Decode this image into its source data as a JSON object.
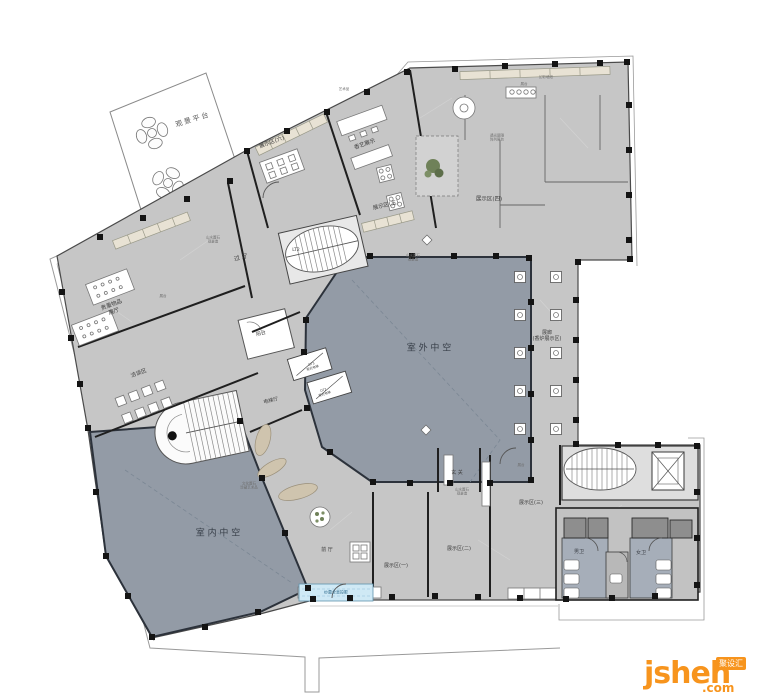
{
  "document": {
    "type": "architectural-floor-plan"
  },
  "colors": {
    "floor": "#c6c6c6",
    "atrium_blue": "#939ba6",
    "restroom_blue": "#a6aeb9",
    "stall_gray": "#8e8e8e",
    "wall_black": "#1f1f1f",
    "outline": "#4a4a4a",
    "site_line": "#9a9a9a",
    "counter_tan": "#e8e2d4",
    "glass_blue": "#cfe9f5",
    "plant_green": "#6f8159",
    "sculpture_tan": "#cfc4ae",
    "logo_orange": "#f7941d"
  },
  "watermark": {
    "brand": "jsheh",
    "tld": ".com",
    "badge": "聚设汇"
  },
  "plan": {
    "rooms": [
      {
        "id": "viewing-platform",
        "label": "观景平台"
      },
      {
        "id": "display-area-6",
        "label": "展示区(六)"
      },
      {
        "id": "incense-art-display",
        "label": "香艺展示"
      },
      {
        "id": "display-area-5",
        "label": "展示区(五)"
      },
      {
        "id": "display-area-4",
        "label": "展示区(四)"
      },
      {
        "id": "gallery-corridor",
        "label": "展廊\n(香炉展示区)"
      },
      {
        "id": "outdoor-atrium",
        "label": "室 外 中 空"
      },
      {
        "id": "indoor-atrium",
        "label": "室 内 中 空"
      },
      {
        "id": "passage-hall",
        "label": "过 厅"
      },
      {
        "id": "valuables-hall",
        "label": "贵重物品\n展厅"
      },
      {
        "id": "negotiation-area",
        "label": "洽谈区"
      },
      {
        "id": "balcony",
        "label": "阳台"
      },
      {
        "id": "elevator-hall",
        "label": "电梯厅"
      },
      {
        "id": "front-hall",
        "label": "前 厅"
      },
      {
        "id": "display-area-1",
        "label": "展示区(一)"
      },
      {
        "id": "display-area-2",
        "label": "展示区(二)"
      },
      {
        "id": "display-area-3",
        "label": "展示区(三)"
      },
      {
        "id": "foyer",
        "label": "玄 关"
      },
      {
        "id": "mens-restroom",
        "label": "男卫"
      },
      {
        "id": "womens-restroom",
        "label": "女卫"
      },
      {
        "id": "stair-lt2",
        "label": "LT2"
      },
      {
        "id": "elevator-dt3",
        "label": "DT3\n观光电梯"
      },
      {
        "id": "elevator-dt2",
        "label": "DT2\n观光电梯"
      },
      {
        "id": "holo-screen",
        "label": "纱幕全息投影"
      }
    ],
    "annotations": [
      {
        "label": "山水置石\n观景造"
      },
      {
        "label": "山水置石\n观景造"
      },
      {
        "label": "文化置石\n珍藏艺术品"
      },
      {
        "label": "艺术品"
      },
      {
        "label": "展台"
      },
      {
        "label": "幻彩墙纸"
      },
      {
        "label": "透光屏隔\n阵列展台"
      },
      {
        "label": "展台"
      },
      {
        "label": "展台"
      },
      {
        "label": "山水置石\n观景造"
      }
    ]
  }
}
